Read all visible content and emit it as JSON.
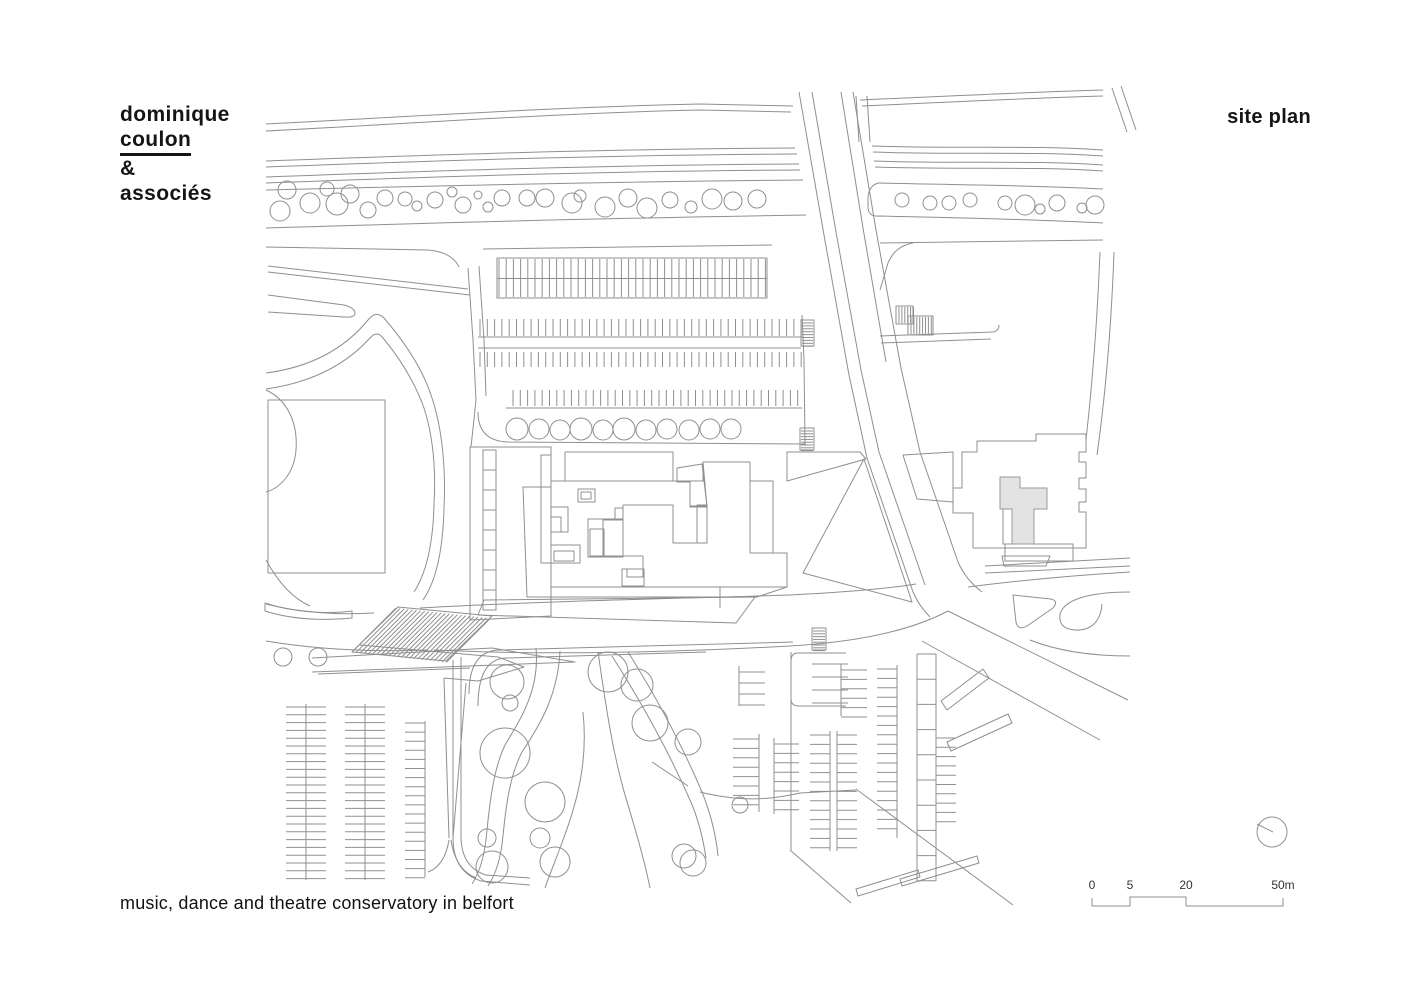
{
  "page": {
    "background": "#ffffff",
    "kind": "architectural site plan drawing"
  },
  "branding": {
    "name_line1": "dominique",
    "name_line2": "coulon",
    "name_line3": "&",
    "name_line4": "associés"
  },
  "titleblock": {
    "drawing_label": "site plan",
    "project_title": "music, dance and theatre conservatory in belfort"
  },
  "scale_bar": {
    "tick_labels": [
      "0",
      "5",
      "20",
      "50m"
    ]
  },
  "north_arrow": {
    "style": "circle with needle pointing upper-left"
  },
  "colors": {
    "paper": "#ffffff",
    "line_ink": "#8f8f8f",
    "building_outline": "#0d0d0d",
    "cast_shadow": "#a5a5a5",
    "plaza_fill": "#ededed",
    "soft_shadow": "#e9e9e9",
    "text": "#151515"
  }
}
